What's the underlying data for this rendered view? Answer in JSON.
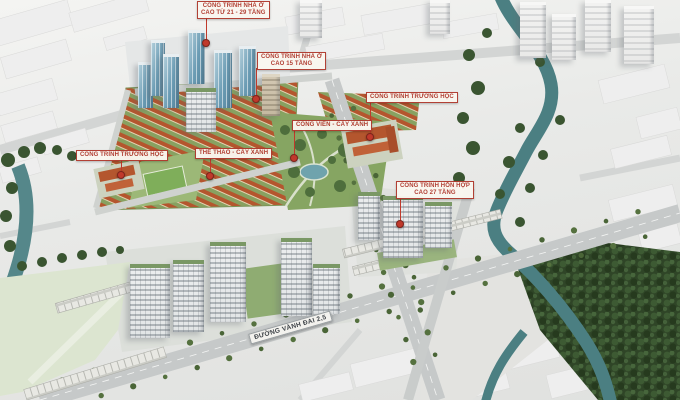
{
  "meta": {
    "description": "Aerial 3D master-plan rendering of an urban residential development with Vietnamese planning callouts"
  },
  "callouts": {
    "housing_tall": {
      "line1": "CÔNG TRÌNH NHÀ Ở",
      "line2": "CAO TỪ 21 - 29 TẦNG"
    },
    "housing_mid": {
      "line1": "CÔNG TRÌNH NHÀ Ở",
      "line2": "CAO 15 TẦNG"
    },
    "school_right": {
      "text": "CÔNG TRÌNH TRƯỜNG HỌC"
    },
    "park": {
      "text": "CÔNG VIÊN - CÂY XANH"
    },
    "sports": {
      "text": "THỂ THAO - CÂY XANH"
    },
    "school_left": {
      "text": "CÔNG TRÌNH TRƯỜNG HỌC"
    },
    "mixed_use": {
      "line1": "CÔNG TRÌNH HỖN HỢP",
      "line2": "CAO 27 TẦNG"
    }
  },
  "road_label": {
    "text": "ĐƯỜNG VÀNH ĐAI 2,5"
  },
  "colors": {
    "callout_red": "#b03a2e",
    "callout_bg": "#faf7f0",
    "pin_red": "#c0392b",
    "river_teal": "#4b7f82",
    "park_green": "#86a562",
    "villa_roof_red": "#b4562e",
    "tower_glass_blue": "#6b9cb4",
    "tower_white": "#e9ebec",
    "roof_green": "#7a9865",
    "road_gray": "#c6c9c9",
    "context_white": "#eeeeee",
    "field_green": "#dce5d0",
    "forest_green": "#2f4527"
  }
}
